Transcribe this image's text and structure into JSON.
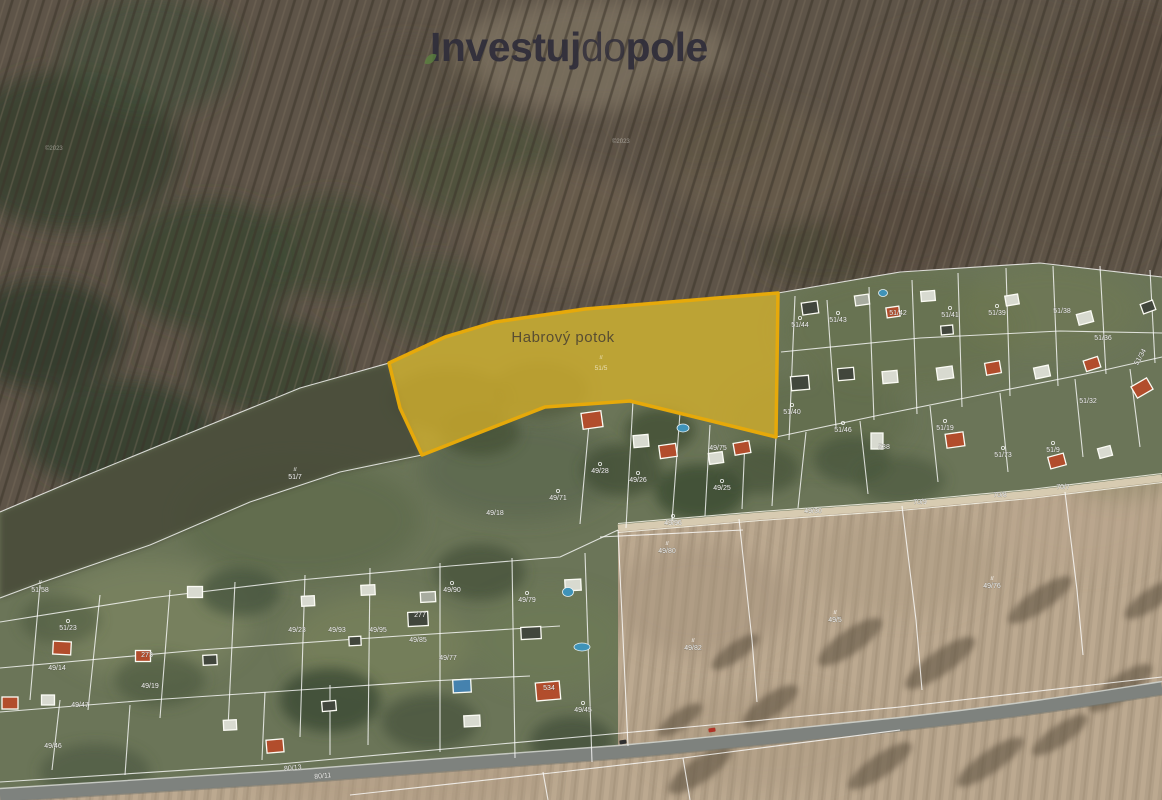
{
  "brand": {
    "logo": {
      "part1": "Investuj",
      "part2": "do",
      "part3": "pole",
      "color": "#302e3b",
      "accent_green": "#5c8440"
    }
  },
  "map": {
    "type": "satellite-cadastre",
    "watermarks": [
      {
        "text": "©2023",
        "x": 45,
        "y": 150
      },
      {
        "text": "©2023",
        "x": 612,
        "y": 143
      }
    ],
    "highlight": {
      "label": "Habrový potok",
      "parcel_symbol": "il",
      "parcel_number": "51/5",
      "fill": "#d3af2c",
      "stroke": "#e6a90a",
      "polygon": "389,363 445,337 495,322 585,309 778,293 776,437 630,401 545,407 422,455 400,408"
    },
    "colors": {
      "house": {
        "red": "#b24d2c",
        "white": "#d8dad0",
        "dark": "#41463c",
        "gray": "#a8aca0",
        "blue": "#4582ae"
      },
      "pool": "#3f93b8",
      "boundary_line": "#ffffff",
      "road": "#7e827e",
      "field": "#b2a088",
      "forest": "#5e5448",
      "meadow": "#6b7558"
    },
    "parcel_labels": [
      {
        "t": "51/44",
        "x": 800,
        "y": 327,
        "s": "o"
      },
      {
        "t": "51/43",
        "x": 838,
        "y": 322,
        "s": "o"
      },
      {
        "t": "51/42",
        "x": 898,
        "y": 315
      },
      {
        "t": "51/41",
        "x": 950,
        "y": 317,
        "s": "o"
      },
      {
        "t": "51/39",
        "x": 997,
        "y": 315,
        "s": "o"
      },
      {
        "t": "51/38",
        "x": 1062,
        "y": 313
      },
      {
        "t": "51/36",
        "x": 1103,
        "y": 340
      },
      {
        "t": "51/34",
        "x": 1142,
        "y": 358,
        "r": -60
      },
      {
        "t": "51/40",
        "x": 792,
        "y": 414,
        "s": "o"
      },
      {
        "t": "51/46",
        "x": 843,
        "y": 432,
        "s": "o"
      },
      {
        "t": "538",
        "x": 884,
        "y": 449
      },
      {
        "t": "51/19",
        "x": 945,
        "y": 430,
        "s": "o"
      },
      {
        "t": "51/73",
        "x": 1003,
        "y": 457,
        "s": "o"
      },
      {
        "t": "51/9",
        "x": 1053,
        "y": 452,
        "s": "o"
      },
      {
        "t": "51/32",
        "x": 1088,
        "y": 403
      },
      {
        "t": "70/7",
        "x": 1063,
        "y": 489
      },
      {
        "t": "70/8",
        "x": 1000,
        "y": 497
      },
      {
        "t": "70/9",
        "x": 920,
        "y": 504
      },
      {
        "t": "49/30",
        "x": 813,
        "y": 513
      },
      {
        "t": "49/80",
        "x": 667,
        "y": 553,
        "s": "il"
      },
      {
        "t": "49/82",
        "x": 693,
        "y": 650,
        "s": "il"
      },
      {
        "t": "49/5",
        "x": 835,
        "y": 622,
        "s": "il"
      },
      {
        "t": "49/76",
        "x": 992,
        "y": 588,
        "s": "il"
      },
      {
        "t": "51/7",
        "x": 295,
        "y": 479,
        "s": "il"
      },
      {
        "t": "51/58",
        "x": 40,
        "y": 592,
        "s": "il"
      },
      {
        "t": "51/23",
        "x": 68,
        "y": 630,
        "s": "o"
      },
      {
        "t": "49/47",
        "x": 80,
        "y": 707
      },
      {
        "t": "49/46",
        "x": 53,
        "y": 748
      },
      {
        "t": "49/19",
        "x": 150,
        "y": 688
      },
      {
        "t": "49/14",
        "x": 57,
        "y": 670
      },
      {
        "t": "49/18",
        "x": 495,
        "y": 515
      },
      {
        "t": "49/71",
        "x": 558,
        "y": 500,
        "s": "o"
      },
      {
        "t": "49/28",
        "x": 600,
        "y": 473,
        "s": "o"
      },
      {
        "t": "49/26",
        "x": 638,
        "y": 482,
        "s": "o"
      },
      {
        "t": "49/25",
        "x": 722,
        "y": 490,
        "s": "o"
      },
      {
        "t": "49/75",
        "x": 718,
        "y": 450
      },
      {
        "t": "80/13",
        "x": 293,
        "y": 770,
        "r": -6
      },
      {
        "t": "80/11",
        "x": 323,
        "y": 778,
        "r": -6
      },
      {
        "t": "273",
        "x": 147,
        "y": 657
      },
      {
        "t": "49/23",
        "x": 297,
        "y": 632
      },
      {
        "t": "49/85",
        "x": 418,
        "y": 642
      },
      {
        "t": "49/93",
        "x": 337,
        "y": 632
      },
      {
        "t": "49/95",
        "x": 378,
        "y": 632
      },
      {
        "t": "49/90",
        "x": 452,
        "y": 592,
        "s": "o"
      },
      {
        "t": "49/79",
        "x": 527,
        "y": 602,
        "s": "o"
      },
      {
        "t": "277",
        "x": 420,
        "y": 617
      },
      {
        "t": "534",
        "x": 549,
        "y": 690
      },
      {
        "t": "49/45",
        "x": 583,
        "y": 712,
        "s": "o"
      },
      {
        "t": "49/77",
        "x": 448,
        "y": 660
      },
      {
        "t": "49/96",
        "x": 673,
        "y": 525,
        "s": "o"
      }
    ],
    "boundaries": [
      "778,293 900,272 1040,263 1162,277",
      "776,437 880,415 990,393 1100,371 1162,357",
      "781,352 920,338 1060,331 1162,333",
      "795,296 789,440",
      "827,300 836,427",
      "869,287 874,420",
      "912,280 917,414",
      "958,273 962,407",
      "1006,268 1010,396",
      "1053,266 1058,386",
      "1100,266 1106,374",
      "1150,270 1155,363",
      "806,432 798,508",
      "860,421 868,494",
      "930,406 938,482",
      "1000,393 1008,472",
      "1075,379 1083,457",
      "1130,369 1140,447",
      "590,413 580,524",
      "633,401 626,528",
      "680,413 672,521",
      "710,425 705,516",
      "745,440 742,509",
      "776,437 772,506",
      "389,363 300,388 180,437 80,478 0,512",
      "422,455 340,472 250,502 150,545 40,583 0,598",
      "0,622 150,598 300,580 450,566 560,557 618,530",
      "40,585 30,700",
      "100,595 88,710",
      "170,590 160,718",
      "235,582 228,728",
      "305,575 300,737",
      "370,568 368,745",
      "440,563 440,752",
      "512,558 515,758",
      "585,553 592,762",
      "0,668 200,650 400,636 560,626",
      "0,712 150,700 300,690 430,681 530,676",
      "0,782 280,764 500,744 700,726 900,707 1100,684 1162,677",
      "350,795 560,772 683,758 900,730",
      "683,758 690,800",
      "543,772 548,800",
      "618,530 628,746",
      "739,519 752,640 757,702",
      "902,506 916,620 922,690",
      "1065,492 1077,590 1083,655",
      "600,537 743,530",
      "60,700 52,770",
      "130,705 125,775",
      "265,692 262,760",
      "330,685 330,755"
    ],
    "houses": [
      [
        810,
        308,
        16,
        12,
        -8,
        "dark"
      ],
      [
        862,
        300,
        14,
        10,
        -8,
        "gray"
      ],
      [
        893,
        312,
        13,
        10,
        -8,
        "red"
      ],
      [
        928,
        296,
        14,
        10,
        -5,
        "white"
      ],
      [
        947,
        330,
        12,
        9,
        -5,
        "dark"
      ],
      [
        1012,
        300,
        13,
        10,
        -10,
        "white"
      ],
      [
        1085,
        318,
        15,
        11,
        -15,
        "white"
      ],
      [
        1148,
        307,
        13,
        10,
        -20,
        "dark"
      ],
      [
        800,
        383,
        18,
        14,
        -5,
        "dark"
      ],
      [
        846,
        374,
        16,
        12,
        -5,
        "dark"
      ],
      [
        890,
        377,
        15,
        12,
        -5,
        "white"
      ],
      [
        945,
        373,
        16,
        12,
        -8,
        "white"
      ],
      [
        993,
        368,
        15,
        12,
        -10,
        "red"
      ],
      [
        1042,
        372,
        15,
        11,
        -12,
        "white"
      ],
      [
        1092,
        364,
        15,
        11,
        -18,
        "red"
      ],
      [
        1142,
        388,
        18,
        13,
        -30,
        "red"
      ],
      [
        877,
        441,
        12,
        16,
        0,
        "white"
      ],
      [
        955,
        440,
        18,
        14,
        -8,
        "red"
      ],
      [
        1057,
        461,
        16,
        12,
        -15,
        "red"
      ],
      [
        1105,
        452,
        13,
        10,
        -15,
        "white"
      ],
      [
        592,
        420,
        20,
        16,
        -8,
        "red"
      ],
      [
        641,
        441,
        15,
        12,
        -5,
        "white"
      ],
      [
        668,
        451,
        17,
        13,
        -8,
        "red"
      ],
      [
        716,
        458,
        14,
        11,
        -8,
        "white"
      ],
      [
        742,
        448,
        16,
        12,
        -10,
        "red"
      ],
      [
        195,
        592,
        15,
        11,
        0,
        "white"
      ],
      [
        62,
        648,
        18,
        13,
        3,
        "red"
      ],
      [
        143,
        656,
        15,
        11,
        0,
        "red"
      ],
      [
        10,
        703,
        16,
        12,
        0,
        "red"
      ],
      [
        48,
        700,
        13,
        10,
        0,
        "white"
      ],
      [
        210,
        660,
        14,
        10,
        -3,
        "dark"
      ],
      [
        275,
        746,
        17,
        13,
        -5,
        "red"
      ],
      [
        230,
        725,
        13,
        10,
        -3,
        "white"
      ],
      [
        329,
        706,
        14,
        10,
        -5,
        "dark"
      ],
      [
        418,
        619,
        20,
        14,
        -3,
        "dark"
      ],
      [
        428,
        597,
        15,
        10,
        -3,
        "gray"
      ],
      [
        462,
        686,
        18,
        13,
        -3,
        "blue"
      ],
      [
        531,
        633,
        20,
        12,
        -3,
        "dark"
      ],
      [
        548,
        691,
        24,
        18,
        -5,
        "red"
      ],
      [
        472,
        721,
        16,
        11,
        -3,
        "white"
      ],
      [
        368,
        590,
        14,
        10,
        -3,
        "white"
      ],
      [
        573,
        585,
        16,
        11,
        -3,
        "white"
      ],
      [
        355,
        641,
        12,
        9,
        -3,
        "dark"
      ],
      [
        308,
        601,
        13,
        10,
        -3,
        "white"
      ]
    ],
    "pools": [
      [
        683,
        428,
        12,
        8
      ],
      [
        568,
        592,
        11,
        9
      ],
      [
        582,
        647,
        16,
        8
      ],
      [
        883,
        293,
        9,
        7
      ]
    ],
    "cars": [
      {
        "x": 712,
        "y": 730,
        "color": "#b03226",
        "rot": -8
      },
      {
        "x": 623,
        "y": 742,
        "color": "#2f2f2f",
        "rot": -8
      }
    ]
  }
}
